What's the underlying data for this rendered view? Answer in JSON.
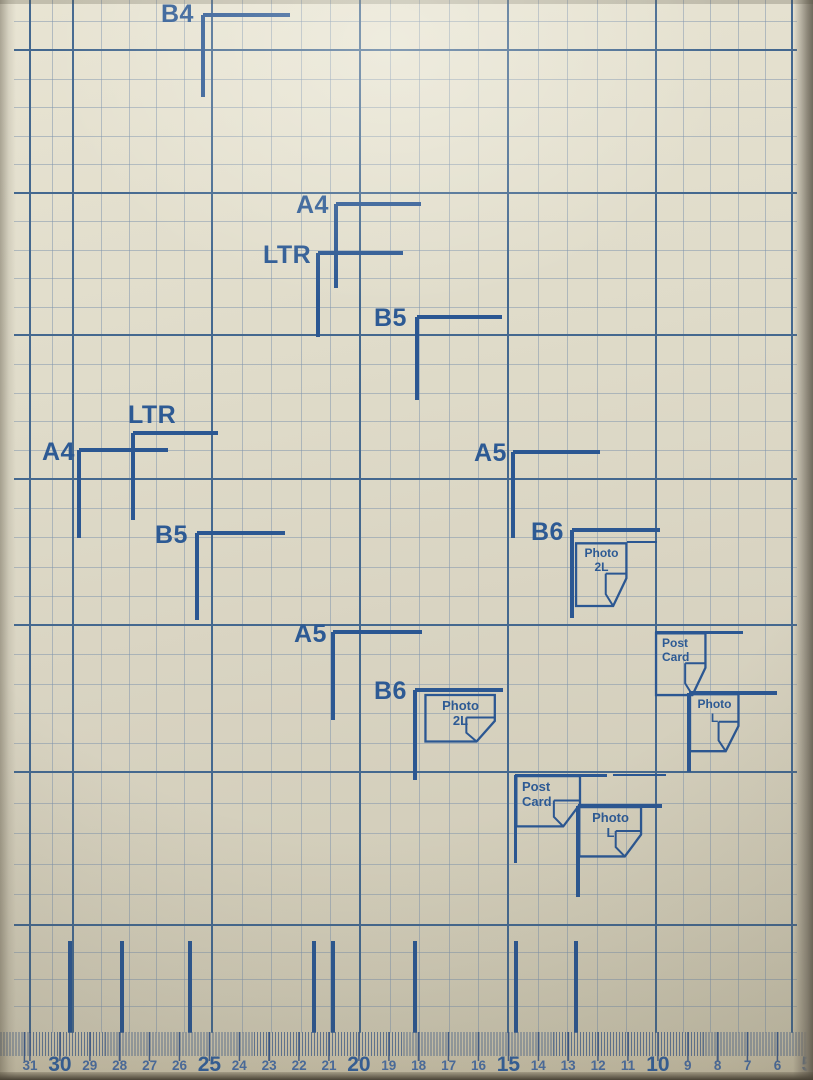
{
  "scene": "printer-scanner paper alignment platen photographed from above",
  "colors": {
    "paper": "#dcd8c6",
    "fine_line": "rgba(124,146,172,0.5)",
    "major_line": "#44688f",
    "marker": "#2b5792",
    "label": "#2d5a94",
    "number_small": "#4a6fa5",
    "number_big": "#33619e"
  },
  "grid": {
    "area": {
      "left": 14,
      "top": 0,
      "right": 797,
      "bottom": 1033
    },
    "major_x": [
      30,
      73,
      212,
      360,
      508,
      656,
      792
    ],
    "major_y": [
      50,
      193,
      335,
      479,
      625,
      772,
      925
    ],
    "virtual_top_y": -93,
    "fine_cell": 28.5
  },
  "size_markers": [
    {
      "label": "B4",
      "lx": 161,
      "ly": 2,
      "x": 203,
      "y": 15,
      "h": 87,
      "v": 82
    },
    {
      "label": "A4",
      "lx": 296,
      "ly": 193,
      "x": 336,
      "y": 204,
      "h": 85,
      "v": 84
    },
    {
      "label": "LTR",
      "lx": 263,
      "ly": 243,
      "x": 318,
      "y": 253,
      "h": 85,
      "v": 84
    },
    {
      "label": "B5",
      "lx": 374,
      "ly": 306,
      "x": 417,
      "y": 317,
      "h": 85,
      "v": 83
    },
    {
      "label": "LTR",
      "lx": 128,
      "ly": 403,
      "x": 133,
      "y": 433,
      "h": 85,
      "v": 87
    },
    {
      "label": "A4",
      "lx": 42,
      "ly": 440,
      "x": 79,
      "y": 450,
      "h": 89,
      "v": 88
    },
    {
      "label": "B5",
      "lx": 155,
      "ly": 523,
      "x": 197,
      "y": 533,
      "h": 88,
      "v": 87
    },
    {
      "label": "A5",
      "lx": 474,
      "ly": 441,
      "x": 513,
      "y": 452,
      "h": 87,
      "v": 86
    },
    {
      "label": "B6",
      "lx": 531,
      "ly": 520,
      "x": 572,
      "y": 530,
      "h": 88,
      "v": 88
    },
    {
      "label": "A5",
      "lx": 294,
      "ly": 622,
      "x": 333,
      "y": 632,
      "h": 89,
      "v": 88
    },
    {
      "label": "B6",
      "lx": 374,
      "ly": 679,
      "x": 415,
      "y": 690,
      "h": 88,
      "v": 90
    },
    {
      "label": "",
      "lx": 0,
      "ly": 0,
      "x": 689,
      "y": 693,
      "h": 88,
      "v": 79
    },
    {
      "label": "",
      "lx": 0,
      "ly": 0,
      "x": 578,
      "y": 806,
      "h": 84,
      "v": 91
    }
  ],
  "paper_icons": [
    {
      "id": "photo-2l-center",
      "lines": [
        "Photo",
        "2L"
      ],
      "x": 424,
      "y": 694,
      "w": 73,
      "h": 49,
      "align": "center",
      "fs": 13
    },
    {
      "id": "photo-2l-right",
      "lines": [
        "Photo",
        "2L"
      ],
      "x": 575,
      "y": 542,
      "w": 53,
      "h": 66,
      "align": "center",
      "fs": 12
    },
    {
      "id": "post-card-right",
      "lines": [
        "Post",
        "Card"
      ],
      "x": 655,
      "y": 632,
      "w": 52,
      "h": 65,
      "align": "left",
      "fs": 12
    },
    {
      "id": "photo-l-right",
      "lines": [
        "Photo",
        "L"
      ],
      "x": 689,
      "y": 693,
      "w": 51,
      "h": 60,
      "align": "center",
      "fs": 12
    },
    {
      "id": "post-card-center",
      "lines": [
        "Post",
        "Card"
      ],
      "x": 515,
      "y": 775,
      "w": 67,
      "h": 53,
      "align": "left",
      "fs": 13
    },
    {
      "id": "photo-l-center",
      "lines": [
        "Photo",
        "L"
      ],
      "x": 578,
      "y": 806,
      "w": 65,
      "h": 52,
      "align": "center",
      "fs": 13
    }
  ],
  "extra_lines": [
    {
      "x": 655,
      "y": 632,
      "len": 88,
      "dir": "h",
      "w": 3
    },
    {
      "x": 515,
      "y": 775,
      "len": 92,
      "dir": "h",
      "w": 3
    },
    {
      "x": 613,
      "y": 775,
      "len": 53,
      "dir": "h",
      "w": 2
    },
    {
      "x": 515,
      "y": 775,
      "len": 88,
      "dir": "v",
      "w": 3
    },
    {
      "x": 627,
      "y": 542,
      "len": 30,
      "dir": "h",
      "w": 2
    }
  ],
  "ruler": {
    "numbers": [
      31,
      30,
      29,
      28,
      27,
      26,
      25,
      24,
      23,
      22,
      21,
      20,
      19,
      18,
      17,
      16,
      15,
      14,
      13,
      12,
      11,
      10,
      9,
      8,
      7,
      6,
      5
    ],
    "start_x": 30,
    "spacing": 29.9,
    "big_every": 5,
    "numbers_top_big": 1054,
    "numbers_top_small": 1059,
    "tick_xs": [
      70,
      122,
      190,
      314,
      333,
      415,
      516,
      576
    ],
    "tick_top": 941,
    "tick_bottom": 1033,
    "mm_strip_top": 1032,
    "mm_strip_height": 24
  }
}
